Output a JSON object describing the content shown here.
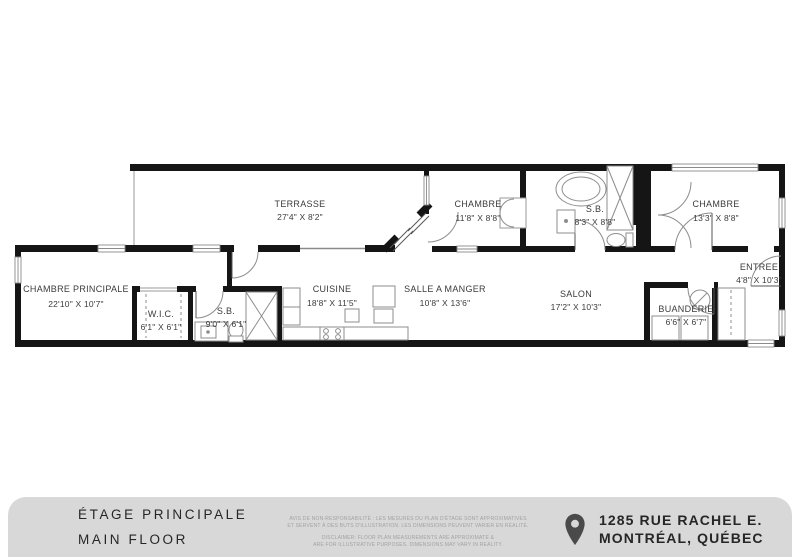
{
  "plan": {
    "title": "floor-plan",
    "rooms": {
      "terrasse": {
        "name": "TERRASSE",
        "dims": "27'4\" X 8'2\""
      },
      "chambre_1": {
        "name": "CHAMBRE",
        "dims": "11'8\" X 8'8\""
      },
      "sb_1": {
        "name": "S.B.",
        "dims": "8'3\" X 8'8\""
      },
      "chambre_2": {
        "name": "CHAMBRE",
        "dims": "13'3\" X 8'8\""
      },
      "entree": {
        "name": "ENTREE",
        "dims": "4'8\" X 10'3\""
      },
      "chambre_principale": {
        "name": "CHAMBRE PRINCIPALE",
        "dims": "22'10\" X 10'7\""
      },
      "wic": {
        "name": "W.I.C.",
        "dims": "6'1\" X 6'1\""
      },
      "sb_2": {
        "name": "S.B.",
        "dims": "9'0\" X 6'1\""
      },
      "cuisine": {
        "name": "CUISINE",
        "dims": "18'8\" X 11'5\""
      },
      "salle_a_manger": {
        "name": "SALLE A MANGER",
        "dims": "10'8\" X 13'6\""
      },
      "salon": {
        "name": "SALON",
        "dims": "17'2\" X 10'3\""
      },
      "buanderie": {
        "name": "BUANDERIE",
        "dims": "6'6\" X 6'7\""
      }
    },
    "colors": {
      "wall": "#151515",
      "thin_line": "#8a8a8a",
      "label": "#3b3b3b"
    }
  },
  "footer": {
    "floor_label_fr": "ÉTAGE PRINCIPALE",
    "floor_label_en": "MAIN FLOOR",
    "disclaimer_fr_line1": "AVIS DE NON-RESPONSABILITÉ : LES MESURES DU PLAN D'ÉTAGE SONT APPROXIMATIVES",
    "disclaimer_fr_line2": "ET SERVENT À DES BUTS D'ILLUSTRATION. LES DIMENSIONS PEUVENT VARIER EN RÉALITÉ.",
    "disclaimer_en_line1": "DISCLAIMER: FLOOR PLAN MEASUREMENTS ARE APPROXIMATE &",
    "disclaimer_en_line2": "ARE FOR ILLUSTRATIVE PURPOSES. DIMENSIONS MAY VARY IN REALITY.",
    "address_line1": "1285 RUE RACHEL E.",
    "address_line2": "MONTRÉAL, QUÉBEC",
    "pin_icon": "location-pin",
    "bar_color": "#d8d8d8",
    "text_color": "#262626",
    "disclaimer_color": "#a2a2a2"
  }
}
